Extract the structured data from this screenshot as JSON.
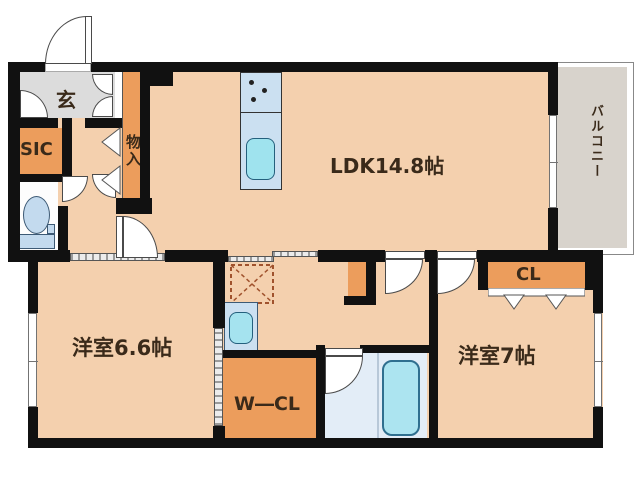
{
  "floorplan": {
    "title": "apartment-floor-plan",
    "rooms": {
      "genkan": {
        "label": "玄"
      },
      "sic": {
        "label": "SIC"
      },
      "monoire": {
        "label": "物入"
      },
      "ldk": {
        "label": "LDK14.8帖"
      },
      "balcony": {
        "label": "バルコニー"
      },
      "cl": {
        "label": "CL"
      },
      "bedroom_east": {
        "label": "洋室7帖"
      },
      "bedroom_west": {
        "label": "洋室6.6帖"
      },
      "wcl": {
        "label": "W―CL"
      }
    },
    "fixtures": {
      "kitchen": "kitchen-counter-with-stove-and-sink",
      "toilet": "toilet-icon",
      "washbasin": "washbasin-icon",
      "bathtub": "bathtub-icon",
      "washing_machine": "washing-machine-space-dashed-box"
    },
    "colors": {
      "floor": "#f4d0ae",
      "closet_orange": "#ec9d5c",
      "genkan_gray": "#dcdcdc",
      "balcony_gray": "#d8d3cc",
      "wall": "#111111",
      "bath_floor": "#e3edf7",
      "tub_cyan": "#ace4f0",
      "counter_blue": "#cbe0f1",
      "text": "#3a2a1a"
    }
  }
}
